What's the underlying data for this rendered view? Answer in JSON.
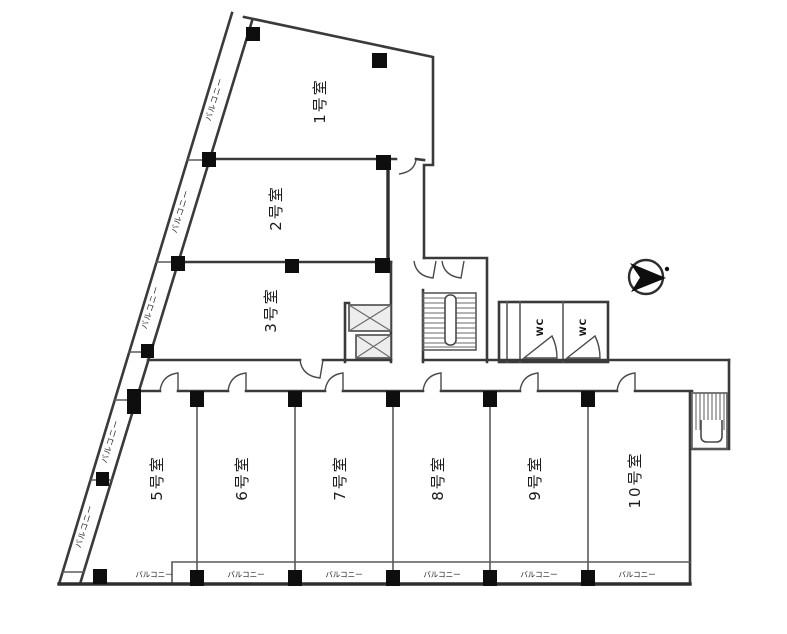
{
  "plan": {
    "rooms": {
      "r1": "1号室",
      "r2": "2号室",
      "r3": "3号室",
      "r5": "5号室",
      "r6": "6号室",
      "r7": "7号室",
      "r8": "8号室",
      "r9": "9号室",
      "r10": "10号室"
    },
    "wc": {
      "stall1": "WC",
      "stall2": "WC"
    },
    "balcony_diagonal": [
      "バルコニー",
      "バルコニー",
      "バルコニー",
      "バルコニー",
      "バルコニー"
    ],
    "balcony_bottom": [
      "バルコニー",
      "バルコニー",
      "バルコニー",
      "バルコニー",
      "バルコニー",
      "バルコニー"
    ],
    "colors": {
      "wall": "#3a3a3a",
      "column": "#0e0e0e",
      "background": "#ffffff"
    }
  }
}
